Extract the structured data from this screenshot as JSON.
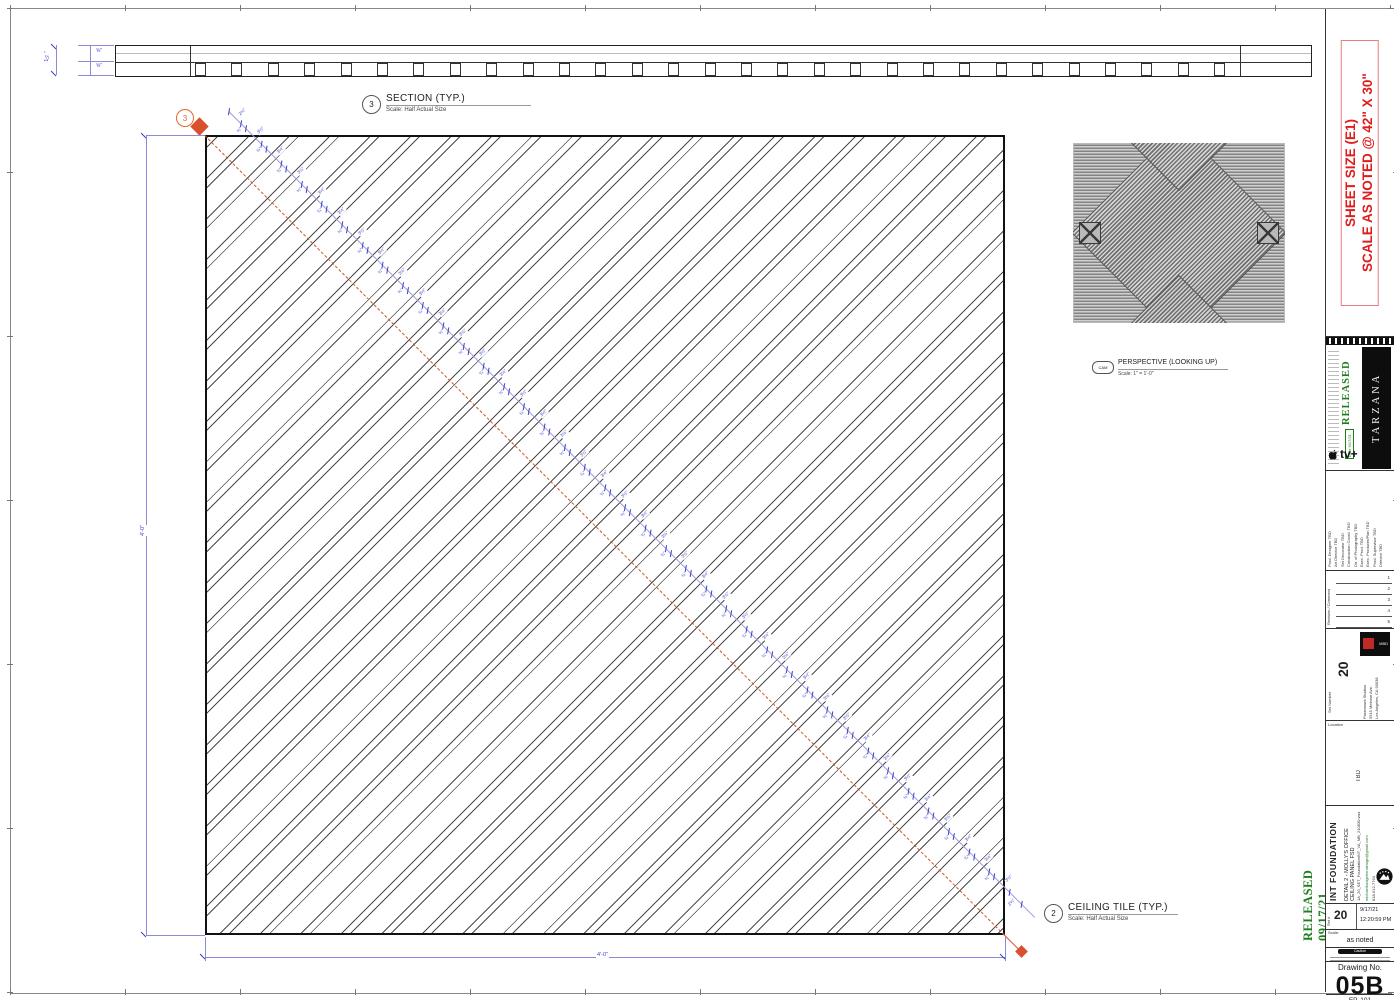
{
  "sheet": {
    "size_line1": "SHEET SIZE (E1)",
    "size_line2": "SCALE AS NOTED @ 42\" X 30\"",
    "released_stamp": "RELEASED  09/17/21"
  },
  "drawings": {
    "section": {
      "number": "3",
      "title": "SECTION (TYP.)",
      "scale": "Scale: Half Actual Size"
    },
    "ceiling": {
      "number": "2",
      "title": "CEILING TILE (TYP.)",
      "scale": "Scale: Half Actual Size"
    },
    "perspective": {
      "number": "CAM",
      "title": "PERSPECTIVE (LOOKING UP)",
      "scale": "Scale: 1\" = 1'-0\""
    }
  },
  "dimensions": {
    "plan_width": "4'-0\"",
    "plan_height": "4'-0\"",
    "section_thickness": "1¼\"",
    "section_sub_top": "⅝\"",
    "section_sub_bot": "⅝\"",
    "diagonal": {
      "start": "2¾\"",
      "pair": [
        "¾\"",
        "3½\""
      ],
      "end": "2¾\"",
      "px": {
        "2¾\"": 17,
        "¾\"": 7,
        "3½\"": 21.6
      },
      "length": 1140
    },
    "batten_count": 29
  },
  "title_block": {
    "production": "TARZANA",
    "network_logo": "tv+",
    "released_label": "RELEASED",
    "released_date": "Date 9/17/21",
    "crew": [
      {
        "role": "Prod. Designer",
        "value": "TBD"
      },
      {
        "role": "Art Director",
        "value": "TBD"
      },
      {
        "role": "Set Decorator",
        "value": "TBD"
      },
      {
        "role": "Construction Coord.",
        "value": "TBD"
      },
      {
        "role": "Dir. of Photography",
        "value": "TBD"
      },
      {
        "role": "Exec. Prod.",
        "value": "TBD"
      },
      {
        "role": "Exec. Producer/Plan",
        "value": "TBD"
      },
      {
        "role": "Prod. Supervisor",
        "value": "TBD"
      },
      {
        "role": "Director",
        "value": "TBD"
      }
    ],
    "revision_header": "Revision / Comment",
    "revision_rows": [
      "1",
      "2",
      "3",
      "4",
      "5"
    ],
    "set_number_label": "Set Number",
    "set_number": "20",
    "studio_address": "Paramount Studios\n5515 Melrose Ave.\nLos Angeles, CA 90038",
    "location_label": "Location",
    "location_value": "TBD",
    "filename": "1A_20_SET_FoundationINT_VA_MB_210830.vwx",
    "contact_email": "michaelbudgehendesign@gmail.com",
    "contact_phone": "818-612-7764",
    "set_title": "INT FOUNDATION",
    "drawing_title": "DETAIL 2 - MOLLY'S OFFICE  CEILING PANEL FSD",
    "set_hash_label": "Set #",
    "set_hash": "20",
    "date": "9/17/21",
    "time": "12:20:59 PM",
    "scale_label": "Scale:",
    "scale_value": "as noted",
    "caution_label": "Caution",
    "drawing_no_label": "Drawing No.",
    "drawing_no": "05B",
    "episode": "EP. 101"
  },
  "colors": {
    "dim_blue": "#3d3dcc",
    "marker_red": "#d8502e",
    "sheet_red": "#e01b1b",
    "stamp_green": "#1e7e1e",
    "hatch_gray": "#4a4a4a"
  }
}
